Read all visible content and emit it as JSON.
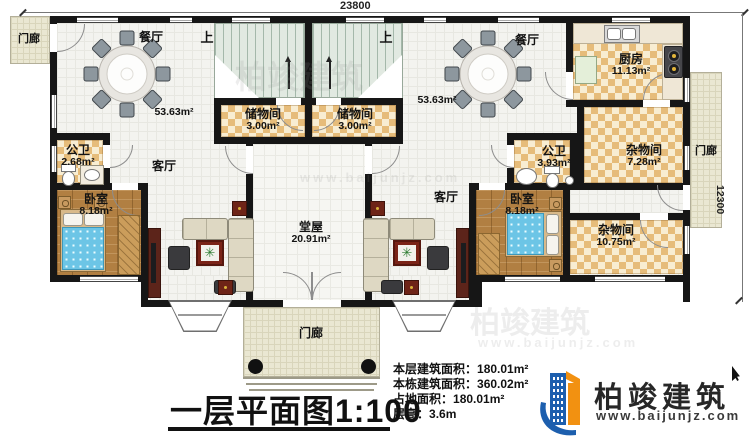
{
  "plan": {
    "title": "一层平面图1:100",
    "dimensions": {
      "top": "23800",
      "right": "12300"
    },
    "rooms": {
      "porch_tl": {
        "name": "门廊"
      },
      "porch_right": {
        "name": "门廊"
      },
      "porch_bottom": {
        "name": "门廊"
      },
      "dining_l": {
        "name": "餐厅",
        "area": "53.63m²"
      },
      "dining_r": {
        "name": "餐厅",
        "area": "53.63m²"
      },
      "stairs_l": {
        "name": "上"
      },
      "stairs_r": {
        "name": "上"
      },
      "storage_l": {
        "name": "储物间",
        "area": "3.00m²"
      },
      "storage_r": {
        "name": "储物间",
        "area": "3.00m²"
      },
      "bath_l": {
        "name": "公卫",
        "area": "2.68m²"
      },
      "bath_r": {
        "name": "公卫",
        "area": "3.93m²"
      },
      "kitchen": {
        "name": "厨房",
        "area": "11.13m²"
      },
      "utility_a": {
        "name": "杂物间",
        "area": "7.28m²"
      },
      "utility_b": {
        "name": "杂物间",
        "area": "10.75m²"
      },
      "bedroom_l": {
        "name": "卧室",
        "area": "8.18m²"
      },
      "bedroom_r": {
        "name": "卧室",
        "area": "8.18m²"
      },
      "living_l": {
        "name": "客厅"
      },
      "living_r": {
        "name": "客厅"
      },
      "hall": {
        "name": "堂屋",
        "area": "20.91m²"
      }
    }
  },
  "info": {
    "lines": [
      {
        "label": "本层建筑面积：",
        "value": "180.01m²"
      },
      {
        "label": "本栋建筑面积：",
        "value": "360.02m²"
      },
      {
        "label": "占地面积：",
        "value": "180.01m²"
      },
      {
        "label": "层高：",
        "value": "3.6m"
      }
    ]
  },
  "brand": {
    "name": "柏竣建筑",
    "url": "www.baijunjz.com"
  },
  "watermark": {
    "brand": "柏竣建筑",
    "url": "www.baijunjz.com"
  }
}
